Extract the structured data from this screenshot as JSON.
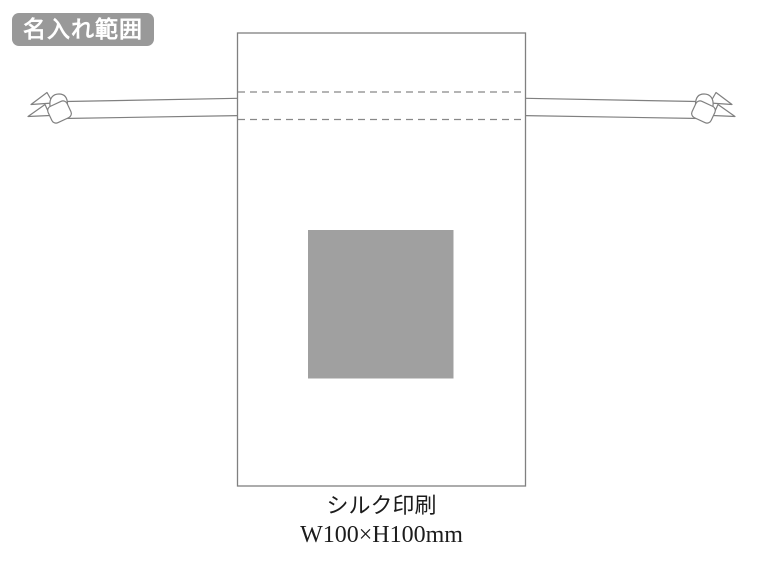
{
  "badge": {
    "label": "名入れ範囲",
    "bg_color": "#999999",
    "text_color": "#ffffff"
  },
  "caption": {
    "method": "シルク印刷",
    "size": "W100×H100mm"
  },
  "illustration": {
    "type": "drawstring-pouch-print-area-diagram",
    "print_area_color": "#a0a0a0",
    "outline_color": "#808080",
    "dash_color": "#888888",
    "background_color": "#ffffff"
  }
}
